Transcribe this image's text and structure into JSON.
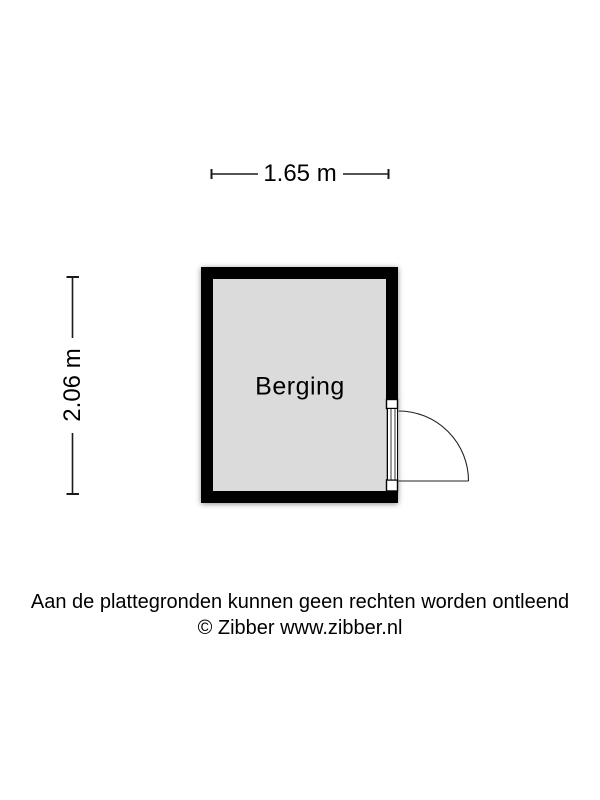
{
  "floorplan": {
    "room": {
      "label": "Berging"
    },
    "dimensions": {
      "width_label": "1.65 m",
      "height_label": "2.06 m"
    },
    "footer": {
      "disclaimer": "Aan de plattegronden kunnen geen rechten worden ontleend",
      "copyright": "© Zibber www.zibber.nl"
    },
    "colors": {
      "wall": "#000000",
      "room_fill": "#dbdbdb",
      "background": "#ffffff",
      "line": "#1a1a1a"
    }
  }
}
